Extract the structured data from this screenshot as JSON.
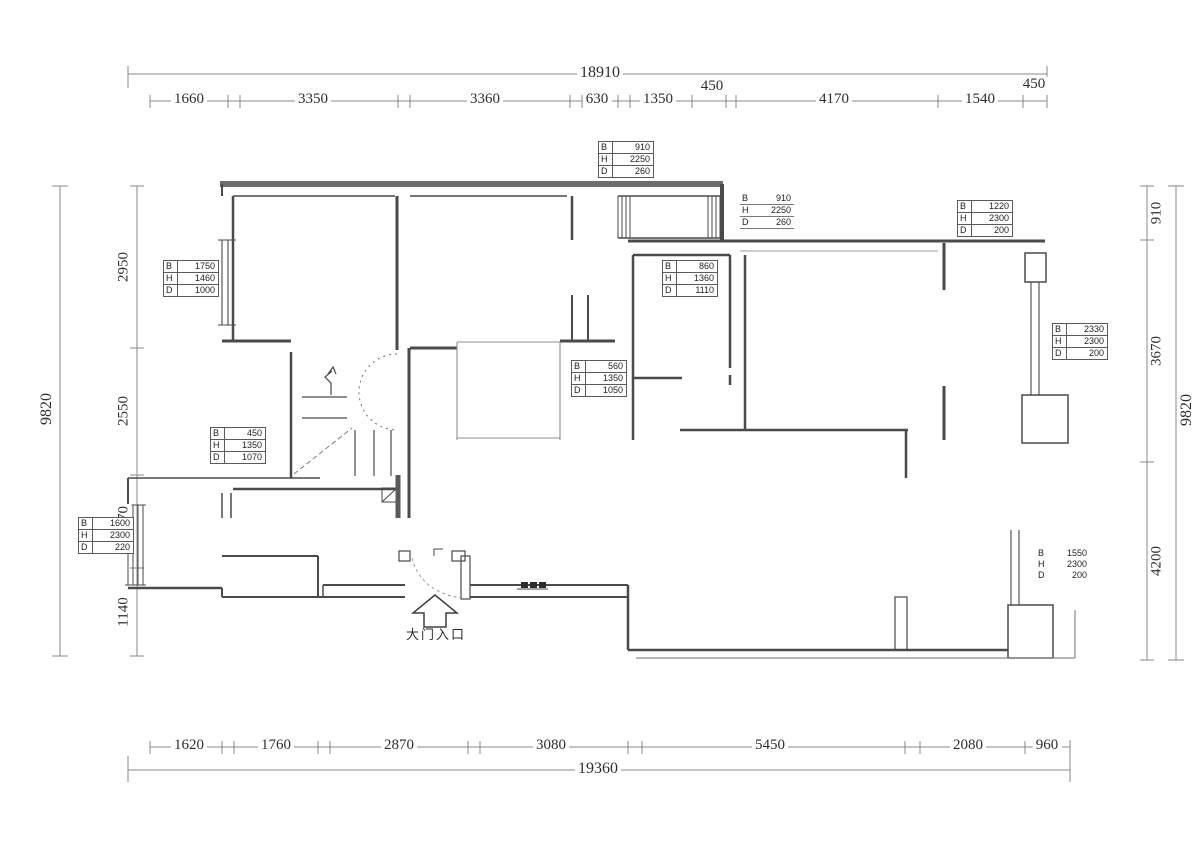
{
  "labels": {
    "b": "B",
    "h": "H",
    "d": "D"
  },
  "entrance": {
    "label": "大门入口"
  },
  "dims": {
    "top": {
      "overall": "18910",
      "segments": [
        "1660",
        "3350",
        "3360",
        "630",
        "1350",
        "450",
        "4170",
        "1540",
        "450"
      ]
    },
    "bottom": {
      "overall": "19360",
      "segments": [
        "1620",
        "1760",
        "2870",
        "3080",
        "5450",
        "2080",
        "960"
      ]
    },
    "left": {
      "overall": "9820",
      "segments": [
        "2950",
        "2550",
        "1970",
        "1140"
      ]
    },
    "right": {
      "overall": "9820",
      "segments": [
        "910",
        "3670",
        "4200"
      ]
    }
  },
  "window_tables": [
    {
      "name": "top-bay-window",
      "b": "910",
      "h": "2250",
      "d": "260"
    },
    {
      "name": "top-bay-window-side",
      "b": "910",
      "h": "2250",
      "d": "260"
    },
    {
      "name": "top-right-window",
      "b": "1220",
      "h": "2300",
      "d": "200"
    },
    {
      "name": "left-room-window",
      "b": "1750",
      "h": "1460",
      "d": "1000"
    },
    {
      "name": "bath-window",
      "b": "860",
      "h": "1360",
      "d": "1110"
    },
    {
      "name": "hall-opening",
      "b": "560",
      "h": "1350",
      "d": "1050"
    },
    {
      "name": "stair-opening",
      "b": "450",
      "h": "1350",
      "d": "1070"
    },
    {
      "name": "lower-left-window",
      "b": "1600",
      "h": "2300",
      "d": "220"
    },
    {
      "name": "right-side-window",
      "b": "2330",
      "h": "2300",
      "d": "200"
    },
    {
      "name": "lower-right-window",
      "b": "1550",
      "h": "2300",
      "d": "200"
    }
  ],
  "colors": {
    "wall": "#4a4a4a",
    "dim_line": "#8a8a8a",
    "text": "#2e2e2e"
  }
}
